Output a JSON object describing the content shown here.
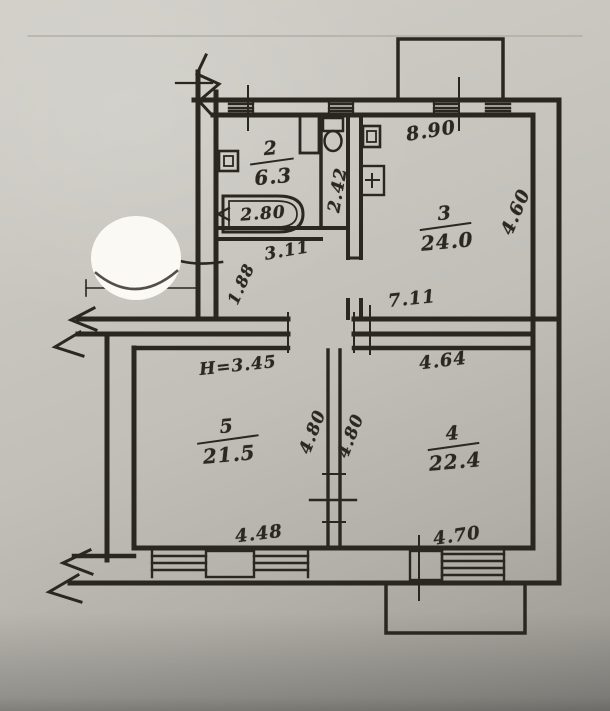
{
  "plan": {
    "ink_color": "#2a2620",
    "paper_color": "#c6c4bd",
    "sticker_color": "#faf9f4",
    "rooms": [
      {
        "number": "2",
        "area": "6.3"
      },
      {
        "number": "3",
        "area": "24.0"
      },
      {
        "number": "5",
        "area": "21.5"
      },
      {
        "number": "4",
        "area": "22.4"
      }
    ],
    "dimensions": {
      "top_wall": "8.90",
      "right_wall": "4.60",
      "wc_depth": "2.42",
      "bathtub": "2.80",
      "hall_width": "3.11",
      "entry": "1.88",
      "living_width": "7.11",
      "room4_width": "4.64",
      "ceiling_height": "H=3.45",
      "room5_depth": "4.80",
      "room4_depth": "4.80",
      "room5_width": "4.48",
      "room4_bottom": "4.70"
    },
    "icons": {
      "bathtub": "bathtub-icon",
      "toilet": "toilet-icon",
      "sink": "sink-icon",
      "stove": "stove-icon",
      "sticker": "round-paper-sticker",
      "wall_break": "wall-break-icon"
    }
  }
}
